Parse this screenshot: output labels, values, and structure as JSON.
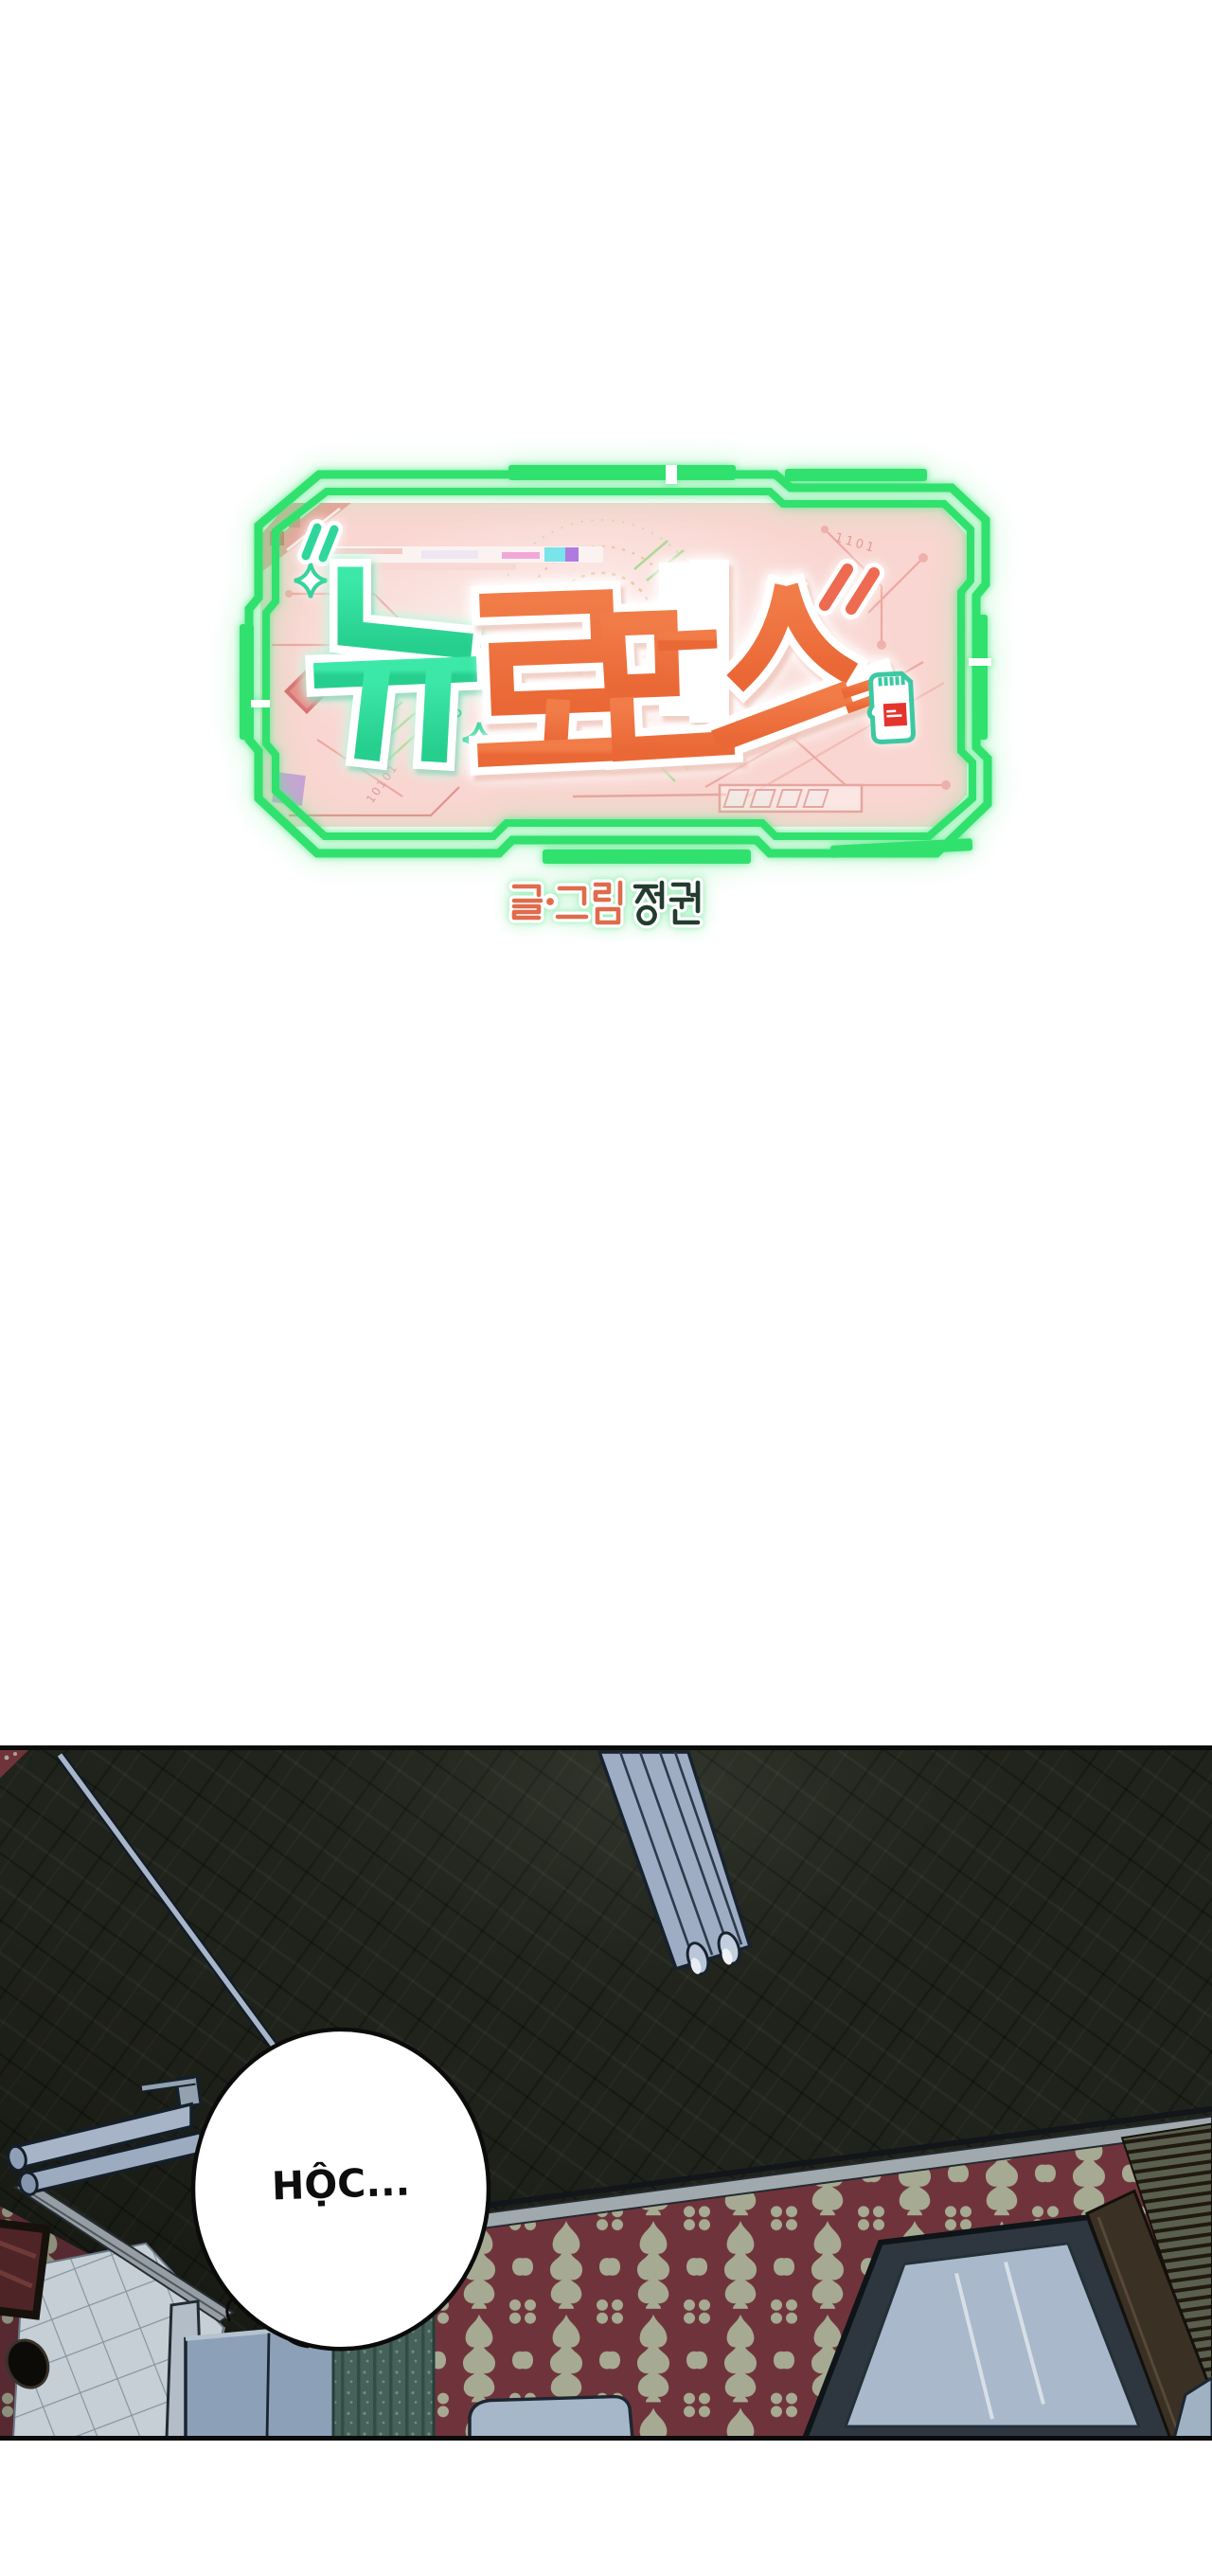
{
  "page": {
    "background_color": "#ffffff"
  },
  "title_card": {
    "series_title": "뉴로맨스",
    "series_title_syllables": [
      "뉴",
      "로",
      "맨",
      "스"
    ],
    "decor_binary_top": "1101",
    "decor_binary_left": "10101",
    "colors": {
      "frame_green": "#31e16e",
      "panel_pink": "#f9d6d1",
      "title_teal": "#32dd9d",
      "title_orange": "#ee7040",
      "circuit_pink": "#efa7a1",
      "sd_card_teal": "#3cc9a2",
      "sd_card_red": "#e5332e"
    }
  },
  "credit": {
    "role_label": "글·그림",
    "author_name": "정권",
    "full": "글·그림 정권",
    "colors": {
      "role_orange": "#df6c4b",
      "name_dark": "#233c30",
      "glow_mint": "#92ecb0"
    }
  },
  "comic_panel": {
    "speech_bubble_text": "HỘC...",
    "colors": {
      "ceiling_dark": "#20231b",
      "wallpaper_red": "#6f343b",
      "wallpaper_motif": "#a6aa93",
      "lamp_gray_blue": "#a2b0c6",
      "furniture_blue": "#8ca0b7",
      "curtain_teal": "#466159",
      "wood_brown": "#3a3024"
    }
  }
}
